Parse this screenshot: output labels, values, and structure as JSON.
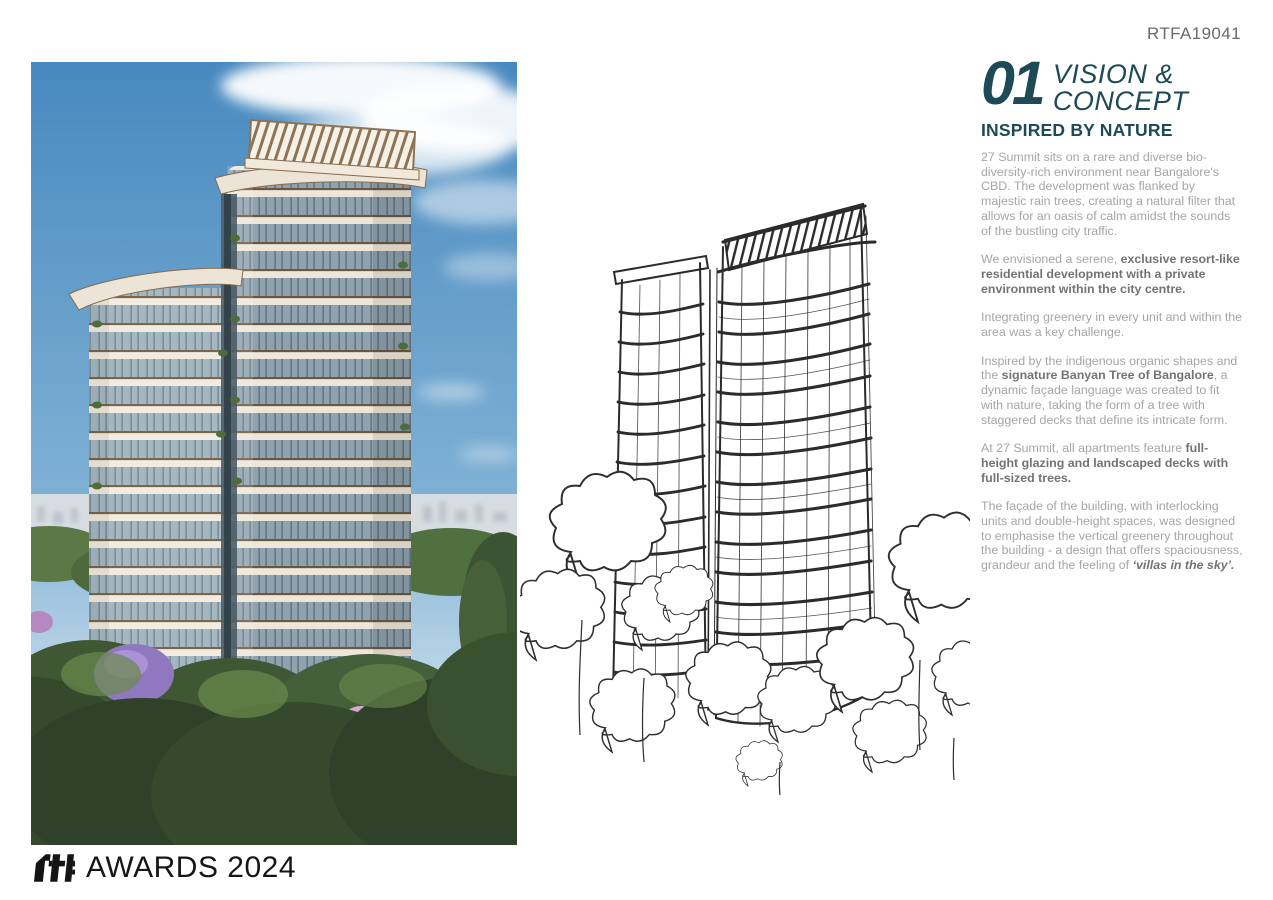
{
  "page": {
    "entry_code": "RTFA19041",
    "background_color": "#ffffff"
  },
  "section_header": {
    "number": "01",
    "title_lines": [
      "VISION &",
      "CONCEPT"
    ],
    "subtitle": "INSPIRED BY NATURE",
    "accent_color": "#1d4a56"
  },
  "article": {
    "text_color": "#a5a5a5",
    "bold_text_color": "#737373",
    "paragraphs": [
      [
        {
          "text": "27 Summit sits on a rare and diverse bio-diversity-rich environment near Bangalore's CBD. The development was flanked by majestic rain trees, creating a natural filter that allows for an oasis of calm amidst the sounds of the bustling city traffic.",
          "bold": false,
          "italic": false
        }
      ],
      [
        {
          "text": "We envisioned a serene, ",
          "bold": false,
          "italic": false
        },
        {
          "text": "exclusive resort-like residential development with a private environment within the city centre.",
          "bold": true,
          "italic": false
        }
      ],
      [
        {
          "text": "Integrating greenery in every unit and within the area was a key challenge.",
          "bold": false,
          "italic": false
        }
      ],
      [
        {
          "text": "Inspired by the indigenous organic shapes and the ",
          "bold": false,
          "italic": false
        },
        {
          "text": "signature Banyan Tree of Bangalore",
          "bold": true,
          "italic": false
        },
        {
          "text": ", a dynamic façade language was created to fit with nature, taking the form of a tree with staggered decks that define its intricate form.",
          "bold": false,
          "italic": false
        }
      ],
      [
        {
          "text": "At 27 Summit, all apartments feature ",
          "bold": false,
          "italic": false
        },
        {
          "text": "full-height glazing and landscaped decks with full-sized trees.",
          "bold": true,
          "italic": false
        }
      ],
      [
        {
          "text": "The façade of the building, with interlocking units and double-height spaces, was designed to emphasise the vertical greenery throughout the building - a design that offers spaciousness, grandeur and the feeling of ",
          "bold": false,
          "italic": false
        },
        {
          "text": "‘villas in the sky’.",
          "bold": true,
          "italic": true
        }
      ]
    ]
  },
  "figures": {
    "photo_caption": "render of 27 Summit tower amid trees",
    "sketch_caption": "concept ink sketch of tower"
  },
  "footer": {
    "logo_text": "rtf",
    "label": "AWARDS 2024"
  }
}
